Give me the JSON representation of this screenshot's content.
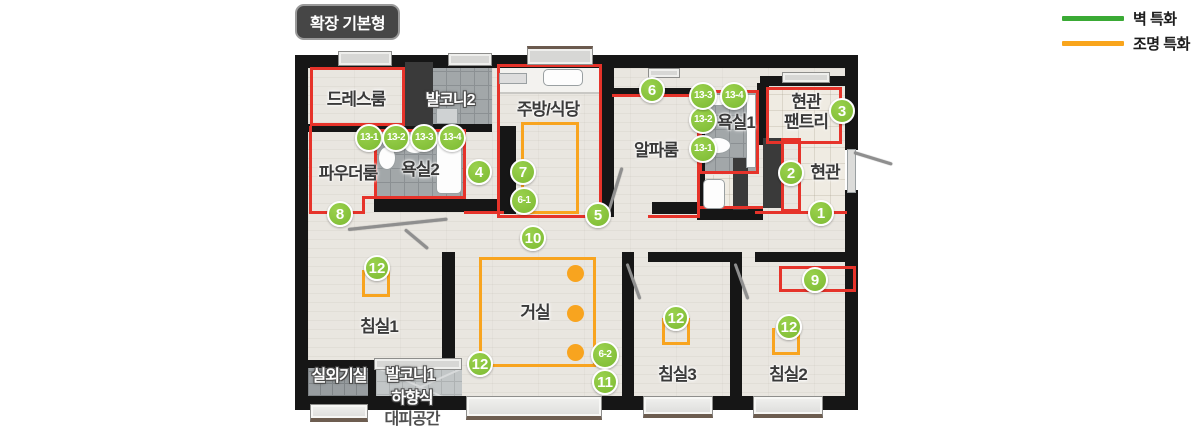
{
  "title": "확장 기본형",
  "legend": {
    "items": [
      {
        "label": "벽 특화",
        "color": "#3aaa35"
      },
      {
        "label": "조명 특화",
        "color": "#f9a51c"
      }
    ]
  },
  "rooms": [
    {
      "key": "dressroom",
      "label": "드레스룸",
      "x": 356,
      "y": 100,
      "variant": "dark"
    },
    {
      "key": "balcony2",
      "label": "발코니2",
      "x": 450,
      "y": 101,
      "variant": "halo"
    },
    {
      "key": "powder-room",
      "label": "파우더룸",
      "x": 348,
      "y": 174,
      "variant": "dark"
    },
    {
      "key": "bathroom2",
      "label": "욕실2",
      "x": 420,
      "y": 170,
      "variant": "dark"
    },
    {
      "key": "kitchen-dining",
      "label": "주방/식당",
      "x": 548,
      "y": 110,
      "variant": "dark"
    },
    {
      "key": "alpha-room",
      "label": "알파룸",
      "x": 656,
      "y": 151,
      "variant": "dark"
    },
    {
      "key": "bathroom1",
      "label": "욕실1",
      "x": 736,
      "y": 123,
      "variant": "dark"
    },
    {
      "key": "entrance-pantry",
      "label": "현관\n팬트리",
      "x": 806,
      "y": 112,
      "variant": "dark"
    },
    {
      "key": "entrance",
      "label": "현관",
      "x": 825,
      "y": 173,
      "variant": "dark"
    },
    {
      "key": "bedroom1",
      "label": "침실1",
      "x": 379,
      "y": 327,
      "variant": "dark"
    },
    {
      "key": "living-room",
      "label": "거실",
      "x": 535,
      "y": 313,
      "variant": "dark"
    },
    {
      "key": "bedroom3",
      "label": "침실3",
      "x": 677,
      "y": 375,
      "variant": "dark"
    },
    {
      "key": "bedroom2",
      "label": "침실2",
      "x": 788,
      "y": 375,
      "variant": "dark"
    },
    {
      "key": "outdoor-unit-room",
      "label": "실외기실",
      "x": 339,
      "y": 377,
      "variant": "halo"
    },
    {
      "key": "balcony1",
      "label": "발코니1",
      "x": 410,
      "y": 376,
      "variant": "halo"
    },
    {
      "key": "evac-space-line1",
      "label": "하향식",
      "x": 412,
      "y": 399,
      "variant": "halo"
    },
    {
      "key": "evac-space-line2",
      "label": "대피공간",
      "x": 412,
      "y": 420,
      "variant": "plain"
    }
  ],
  "badges": [
    {
      "label": "1",
      "x": 821,
      "y": 213
    },
    {
      "label": "2",
      "x": 791,
      "y": 173
    },
    {
      "label": "3",
      "x": 842,
      "y": 111
    },
    {
      "label": "4",
      "x": 479,
      "y": 172
    },
    {
      "label": "5",
      "x": 598,
      "y": 215
    },
    {
      "label": "6",
      "x": 652,
      "y": 90
    },
    {
      "label": "6-1",
      "x": 524,
      "y": 201
    },
    {
      "label": "6-2",
      "x": 605,
      "y": 355
    },
    {
      "label": "7",
      "x": 523,
      "y": 172
    },
    {
      "label": "8",
      "x": 340,
      "y": 214
    },
    {
      "label": "9",
      "x": 815,
      "y": 280
    },
    {
      "label": "10",
      "x": 533,
      "y": 238
    },
    {
      "label": "11",
      "x": 605,
      "y": 382
    },
    {
      "label": "12",
      "x": 377,
      "y": 268
    },
    {
      "label": "12",
      "x": 480,
      "y": 364
    },
    {
      "label": "12",
      "x": 676,
      "y": 318
    },
    {
      "label": "12",
      "x": 789,
      "y": 327
    },
    {
      "label": "13-1",
      "x": 369,
      "y": 138
    },
    {
      "label": "13-2",
      "x": 396,
      "y": 138
    },
    {
      "label": "13-3",
      "x": 424,
      "y": 138
    },
    {
      "label": "13-4",
      "x": 452,
      "y": 138
    },
    {
      "label": "13-1",
      "x": 703,
      "y": 149
    },
    {
      "label": "13-2",
      "x": 703,
      "y": 120
    },
    {
      "label": "13-3",
      "x": 703,
      "y": 96
    },
    {
      "label": "13-4",
      "x": 734,
      "y": 96
    }
  ]
}
